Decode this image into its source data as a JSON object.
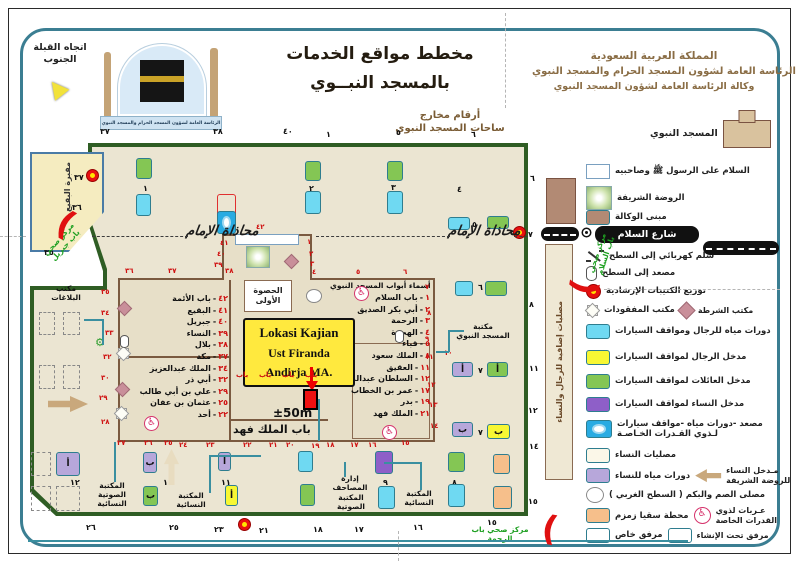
{
  "colors": {
    "accent_teal": "#3b7e92",
    "plaza_green": "#2f5d24",
    "plaza_fill": "#ebe5d2",
    "red": "#cf1010",
    "annotation_yellow": "#ffe93e"
  },
  "header": {
    "qibla_line1": "اتجاه القبلة",
    "qibla_line2": "الجنوب",
    "title_line1": "مخطط مواقع الخدمات",
    "title_line2": "بالمسجد النبــوي",
    "org_line1": "المملكة العربية السعودية",
    "org_line2": "الرئاسة العامة لشؤون المسجد الحرام والمسجد النبوي",
    "org_line3": "وكالة الرئاسة العامة لشؤون المسجد النبوي",
    "logo_banner": "الرئاسة العامة لشؤون المسجد الحرام والمسجد النبوي"
  },
  "exits_label_line1": "أرقام مخارج",
  "exits_label_line2": "ساحات المسجد النبوي",
  "legend": {
    "rows": [
      {
        "y": 120,
        "icon": "building",
        "label": "المسجد النبوي",
        "name": "legend-prophets-mosque"
      },
      {
        "y": 164,
        "icon": "rect-white",
        "label": "السلام على الرسول ﷺ وصاحبيه",
        "name": "legend-salam-on-messenger"
      },
      {
        "y": 186,
        "icon": "rawdah",
        "label": "الروضة الشريفة",
        "name": "legend-rawdah"
      },
      {
        "y": 210,
        "icon": "rect-brown",
        "label": "مبنى الوكالة",
        "name": "legend-agency-building"
      },
      {
        "y": 249,
        "icon": "escalator",
        "label": "سلم كهربائي إلى السطح",
        "name": "legend-escalator"
      },
      {
        "y": 266,
        "icon": "cylinder",
        "label": "مصعد إلى السطح",
        "name": "legend-elevator"
      },
      {
        "y": 284,
        "icon": "booklet",
        "label": "توزيع الكتيبات الإرشادية",
        "name": "legend-booklets"
      },
      {
        "y": 304,
        "icon": "star8",
        "label": "مكتب المفقودات",
        "icon2": "diamond",
        "label2": "مكتب الشرطة",
        "name": "legend-lost-found-police"
      },
      {
        "y": 324,
        "icon": "rect-cyan",
        "label": "دورات مياه للرجال ومواقف السيارات",
        "name": "legend-men-wc-parking"
      },
      {
        "y": 350,
        "icon": "rect-yellow",
        "label": "مدخل الرجال لمواقف السيارات",
        "name": "legend-men-parking-entrance"
      },
      {
        "y": 374,
        "icon": "rect-green",
        "label": "مدخل العائلات لمواقف السيارات",
        "name": "legend-family-parking-entrance"
      },
      {
        "y": 397,
        "icon": "rect-purple",
        "label": "مدخل النساء لمواقف السيارات",
        "name": "legend-women-parking-entrance"
      },
      {
        "y": 419,
        "icon": "rect-special",
        "label": "مصعد -دورات مياه -مواقف سيارات\nلـذوي القـدرات الخـاصـة",
        "name": "legend-accessible-services"
      },
      {
        "y": 448,
        "icon": "rect-cream",
        "label": "مصليات النساء",
        "name": "legend-women-prayer-areas"
      },
      {
        "y": 466,
        "icon": "rect-lavender",
        "label": "دورات مياه للنساء",
        "icon2": "arrow-left",
        "label2": "مـدخل النساء\nللروضة الشريفة",
        "name": "legend-women-wc-rawdah-entrance"
      },
      {
        "y": 487,
        "icon": "circle",
        "label": "مصلى الصم والبكم ( السطح الغربي )",
        "name": "legend-deaf-mute-prayer"
      },
      {
        "y": 506,
        "icon": "rect-orange",
        "label": "محطة سقيا زمزم",
        "icon2": "wheelchair",
        "label2": "عـربات لذوي\nالقدرات الخاصة",
        "name": "legend-zamzam-carts"
      },
      {
        "y": 528,
        "icon": "rect-redline",
        "label": "مرفق خاص",
        "icon2": "rect-dashed",
        "label2": "مرفق تحت الإنشاء",
        "name": "legend-private-under-construction"
      }
    ]
  },
  "map": {
    "street_name": "شارع السلام",
    "alignment_text": "محاذاة الإمام",
    "hasua": "الحصوة الأولى",
    "king_fahd_gate": "باب الملك فهد",
    "cemetery": "مقبرة البقيع",
    "tall_box": "مصليات إضافية للرجال والنساء",
    "annotation": {
      "line1": "Lokasi Kajian",
      "line2": "Ust Firanda Andirja MA.",
      "distance": "±50m"
    },
    "gates_right_title": "أسماء أبواب المسجد النبوي",
    "gates_left": [
      {
        "num": "٤٢",
        "name": "باب الأئمة"
      },
      {
        "num": "٤١",
        "name": "البقيع"
      },
      {
        "num": "٤٠",
        "name": "جبريل"
      },
      {
        "num": "٣٩",
        "name": "النساء"
      },
      {
        "num": "٣٨",
        "name": "بلال"
      },
      {
        "num": "٣٧",
        "name": "مكة"
      },
      {
        "num": "٣٤",
        "name": "الملك عبدالعزيز"
      },
      {
        "num": "٣٢",
        "name": "أبي ذر"
      },
      {
        "num": "٢٩",
        "name": "علي بن أبي طالب"
      },
      {
        "num": "٢٥",
        "name": "عثمان بن عفان"
      },
      {
        "num": "٢٢",
        "name": "أحد"
      }
    ],
    "gates_right": [
      {
        "num": "١",
        "name": "باب السلام"
      },
      {
        "num": "٢",
        "name": "أبي بكر الصديق"
      },
      {
        "num": "٣",
        "name": "الرحمة"
      },
      {
        "num": "٤",
        "name": "الهجرة"
      },
      {
        "num": "٥",
        "name": "قباء"
      },
      {
        "num": "٨",
        "name": "الملك سعود"
      },
      {
        "num": "١١",
        "name": "العقيق"
      },
      {
        "num": "١٢",
        "name": "السلطان عبدالمجيد"
      },
      {
        "num": "١٧",
        "name": "عمر بن الخطاب"
      },
      {
        "num": "١٩",
        "name": "بدر"
      },
      {
        "num": "٢١",
        "name": "الملك فهد"
      }
    ],
    "exit_numbers": [
      [
        100,
        127,
        "٣٧"
      ],
      [
        213,
        127,
        "٣٨"
      ],
      [
        283,
        127,
        "٤٠"
      ],
      [
        326,
        130,
        "١"
      ],
      [
        396,
        128,
        "٥"
      ],
      [
        471,
        130,
        "٦"
      ],
      [
        74,
        173,
        "٣٧"
      ],
      [
        72,
        203,
        "٣٦"
      ],
      [
        44,
        248,
        "٣٥"
      ],
      [
        530,
        174,
        "٦"
      ],
      [
        528,
        230,
        "٧"
      ],
      [
        529,
        300,
        "٨"
      ],
      [
        529,
        364,
        "١١"
      ],
      [
        528,
        406,
        "١٢"
      ],
      [
        529,
        442,
        "١٤"
      ],
      [
        528,
        497,
        "١٥"
      ],
      [
        86,
        523,
        "٢٦"
      ],
      [
        169,
        523,
        "٢٥"
      ],
      [
        214,
        525,
        "٢٣"
      ],
      [
        259,
        526,
        "٢١"
      ],
      [
        313,
        525,
        "١٨"
      ],
      [
        354,
        525,
        "١٧"
      ],
      [
        413,
        523,
        "١٦"
      ],
      [
        487,
        518,
        "١٥"
      ],
      [
        143,
        184,
        "١"
      ],
      [
        309,
        184,
        "٢"
      ],
      [
        391,
        183,
        "٣"
      ],
      [
        457,
        185,
        "٤"
      ],
      [
        472,
        220,
        "٥"
      ],
      [
        478,
        283,
        "٦"
      ],
      [
        478,
        366,
        "٧"
      ],
      [
        478,
        428,
        "٧"
      ],
      [
        163,
        478,
        "١١"
      ],
      [
        221,
        478,
        "١١"
      ],
      [
        383,
        478,
        "٩"
      ],
      [
        452,
        478,
        "٨"
      ],
      [
        70,
        478,
        "١٢"
      ]
    ],
    "wall_numbers": [
      [
        125,
        267,
        "٣٦"
      ],
      [
        168,
        267,
        "٣٧"
      ],
      [
        225,
        267,
        "٣٨"
      ],
      [
        256,
        223,
        "٤٢"
      ],
      [
        220,
        239,
        "٤١"
      ],
      [
        217,
        250,
        "٤٠"
      ],
      [
        214,
        261,
        "٣٩"
      ],
      [
        307,
        238,
        "١"
      ],
      [
        309,
        250,
        "٢"
      ],
      [
        310,
        260,
        "٣"
      ],
      [
        312,
        268,
        "٤"
      ],
      [
        356,
        268,
        "٥"
      ],
      [
        403,
        268,
        "٦"
      ],
      [
        425,
        283,
        "٧"
      ],
      [
        427,
        309,
        "٨"
      ],
      [
        425,
        335,
        "٩"
      ],
      [
        425,
        353,
        "١١"
      ],
      [
        427,
        381,
        "١٢"
      ],
      [
        429,
        401,
        "١٣"
      ],
      [
        430,
        422,
        "١٤"
      ],
      [
        401,
        439,
        "١٥"
      ],
      [
        368,
        441,
        "١٦"
      ],
      [
        350,
        441,
        "١٧"
      ],
      [
        326,
        441,
        "١٨"
      ],
      [
        311,
        442,
        "١٩"
      ],
      [
        286,
        441,
        "٢٠"
      ],
      [
        269,
        441,
        "٢١"
      ],
      [
        243,
        441,
        "٢٢"
      ],
      [
        206,
        441,
        "٢٣"
      ],
      [
        179,
        441,
        "٢٤"
      ],
      [
        164,
        439,
        "٢٥"
      ],
      [
        144,
        439,
        "٢٦"
      ],
      [
        117,
        439,
        "٢٧"
      ],
      [
        101,
        418,
        "٢٨"
      ],
      [
        99,
        394,
        "٢٩"
      ],
      [
        101,
        374,
        "٣٠"
      ],
      [
        103,
        353,
        "٣٢"
      ],
      [
        105,
        329,
        "٣٣"
      ],
      [
        101,
        309,
        "٣٤"
      ],
      [
        101,
        288,
        "٣٥"
      ],
      [
        444,
        349,
        "١٠"
      ],
      [
        236,
        371,
        "باب"
      ],
      [
        259,
        371,
        "باب"
      ],
      [
        282,
        371,
        "باب"
      ],
      [
        305,
        371,
        "باب"
      ]
    ],
    "boxes": [
      [
        136,
        158,
        16,
        21,
        "green"
      ],
      [
        305,
        161,
        16,
        20,
        "green"
      ],
      [
        387,
        161,
        16,
        20,
        "green"
      ],
      [
        136,
        194,
        15,
        22,
        "cyan"
      ],
      [
        305,
        191,
        16,
        23,
        "cyan"
      ],
      [
        387,
        191,
        16,
        23,
        "cyan"
      ],
      [
        217,
        194,
        19,
        23,
        "redline"
      ],
      [
        448,
        217,
        22,
        13,
        "cyan"
      ],
      [
        487,
        216,
        22,
        13,
        "green"
      ],
      [
        455,
        281,
        18,
        15,
        "cyan"
      ],
      [
        485,
        281,
        22,
        15,
        "green"
      ],
      [
        546,
        178,
        30,
        46,
        "brown"
      ],
      [
        452,
        362,
        21,
        15,
        "lpurple",
        "أ"
      ],
      [
        487,
        362,
        21,
        15,
        "green",
        "أ"
      ],
      [
        452,
        422,
        21,
        15,
        "lpurple",
        "ب"
      ],
      [
        487,
        424,
        23,
        15,
        "yellow",
        "ب"
      ],
      [
        143,
        452,
        14,
        21,
        "lpurple",
        "ب"
      ],
      [
        218,
        452,
        13,
        19,
        "lpurple",
        "أ"
      ],
      [
        298,
        451,
        15,
        21,
        "cyan"
      ],
      [
        143,
        486,
        15,
        20,
        "green",
        "ب"
      ],
      [
        225,
        485,
        13,
        21,
        "yellow",
        "أ"
      ],
      [
        300,
        484,
        15,
        22,
        "green"
      ],
      [
        375,
        451,
        18,
        23,
        "purple"
      ],
      [
        448,
        452,
        17,
        20,
        "green"
      ],
      [
        493,
        454,
        17,
        20,
        "orange"
      ],
      [
        378,
        486,
        17,
        23,
        "cyan"
      ],
      [
        448,
        484,
        17,
        23,
        "cyan"
      ],
      [
        493,
        486,
        19,
        23,
        "orange"
      ],
      [
        56,
        452,
        24,
        24,
        "lpurple",
        "أ"
      ]
    ],
    "dashed_boxes": [
      [
        39,
        312,
        16,
        23
      ],
      [
        63,
        312,
        17,
        23
      ],
      [
        39,
        365,
        16,
        24
      ],
      [
        63,
        365,
        17,
        24
      ],
      [
        31,
        452,
        20,
        24
      ],
      [
        31,
        486,
        20,
        25
      ],
      [
        56,
        486,
        24,
        25
      ]
    ],
    "icons": [
      {
        "x": 86,
        "y": 169,
        "k": "booklet"
      },
      {
        "x": 513,
        "y": 226,
        "k": "booklet"
      },
      {
        "x": 238,
        "y": 518,
        "k": "booklet"
      },
      {
        "x": 119,
        "y": 303,
        "k": "diamond"
      },
      {
        "x": 117,
        "y": 384,
        "k": "diamond"
      },
      {
        "x": 286,
        "y": 256,
        "k": "diamond"
      },
      {
        "x": 117,
        "y": 319,
        "k": "star8"
      },
      {
        "x": 115,
        "y": 366,
        "k": "star8"
      },
      {
        "x": 120,
        "y": 335,
        "k": "cyl"
      },
      {
        "x": 395,
        "y": 330,
        "k": "cyl"
      },
      {
        "x": 354,
        "y": 286,
        "k": "wheel"
      },
      {
        "x": 144,
        "y": 416,
        "k": "wheel"
      },
      {
        "x": 382,
        "y": 425,
        "k": "wheel"
      },
      {
        "x": 95,
        "y": 337,
        "k": "gear"
      },
      {
        "x": 306,
        "y": 289,
        "k": "circle"
      },
      {
        "x": 246,
        "y": 246,
        "k": "rawdah"
      },
      {
        "x": 235,
        "y": 234,
        "k": "whitebar"
      },
      {
        "x": 217,
        "y": 157,
        "w": 19,
        "h": 23,
        "k": "special"
      },
      {
        "x": 48,
        "y": 396,
        "w": 40,
        "h": 16,
        "k": "arrow-right"
      },
      {
        "x": 164,
        "y": 449,
        "w": 15,
        "h": 36,
        "k": "arrow-up"
      }
    ],
    "labels": [
      {
        "x": 42,
        "y": 284,
        "w": 48,
        "t": "مكتب\nالبلاغات",
        "k": "",
        "name": "reports-office-label"
      },
      {
        "x": 90,
        "y": 481,
        "w": 44,
        "t": "المكتبة\nالصوتية\nالنسائية",
        "k": "",
        "name": "women-audio-library-label"
      },
      {
        "x": 166,
        "y": 491,
        "w": 50,
        "t": "المكتبة النسائية",
        "k": "",
        "name": "women-library-label"
      },
      {
        "x": 325,
        "y": 474,
        "w": 50,
        "t": "إدارة المصاحف",
        "k": "",
        "name": "mushaf-admin-label"
      },
      {
        "x": 328,
        "y": 493,
        "w": 46,
        "t": "المكتبة الصوتية",
        "k": "",
        "name": "audio-library-label"
      },
      {
        "x": 393,
        "y": 489,
        "w": 52,
        "t": "المكتبة النسائية",
        "k": "",
        "name": "women-library2-label"
      },
      {
        "x": 453,
        "y": 322,
        "w": 60,
        "t": "مكتبة\nالمسجد النبوي",
        "k": "",
        "name": "mosque-library-label"
      },
      {
        "x": 186,
        "y": 223,
        "t": "محاذاة الإمام",
        "k": "callig",
        "name": "imam-alignment-left"
      },
      {
        "x": 448,
        "y": 223,
        "t": "محاذاة الإمام",
        "k": "callig",
        "name": "imam-alignment-right"
      },
      {
        "x": 34,
        "y": 260,
        "w": 64,
        "t": "مركز صحي\nباب جبريل",
        "k": "lab-grn",
        "r": -48,
        "name": "health-center-jibril"
      },
      {
        "x": 583,
        "y": 282,
        "w": 64,
        "t": "مركز صحي\nباب السلام",
        "k": "lab-grn",
        "r": -72,
        "name": "health-center-salam"
      },
      {
        "x": 460,
        "y": 525,
        "w": 80,
        "t": "مركز صحي باب الرحمة",
        "k": "lab-grn",
        "name": "health-center-rahmah"
      },
      {
        "x": 233,
        "y": 423,
        "w": 70,
        "t": "باب الملك فهد",
        "k": "lab-big",
        "name": "king-fahd-gate-label"
      }
    ],
    "lines": [
      [
        114,
        442,
        2,
        40
      ],
      [
        84,
        319,
        20,
        2
      ],
      [
        102,
        319,
        2,
        26
      ],
      [
        209,
        455,
        2,
        38
      ],
      [
        209,
        455,
        52,
        2
      ],
      [
        344,
        462,
        2,
        15
      ],
      [
        448,
        330,
        2,
        22
      ],
      [
        448,
        330,
        16,
        2
      ],
      [
        436,
        351,
        13,
        2
      ],
      [
        420,
        462,
        2,
        28
      ],
      [
        384,
        462,
        38,
        2
      ],
      [
        318,
        399,
        2,
        42
      ],
      [
        28,
        540,
        660,
        2
      ]
    ],
    "dash_lines": [
      [
        92,
        236,
        96
      ],
      [
        316,
        236,
        134
      ],
      [
        514,
        236,
        14
      ]
    ],
    "fold_v": [
      [
        505,
        13,
        95
      ],
      [
        398,
        531,
        30
      ]
    ],
    "fold_h": [
      [
        0,
        236,
        26
      ],
      [
        604,
        289,
        176
      ]
    ],
    "crescents": [
      {
        "x": 58,
        "y": 207,
        "r": 28
      },
      {
        "x": 576,
        "y": 270,
        "r": -80
      },
      {
        "x": 542,
        "y": 512,
        "r": 10
      }
    ]
  }
}
